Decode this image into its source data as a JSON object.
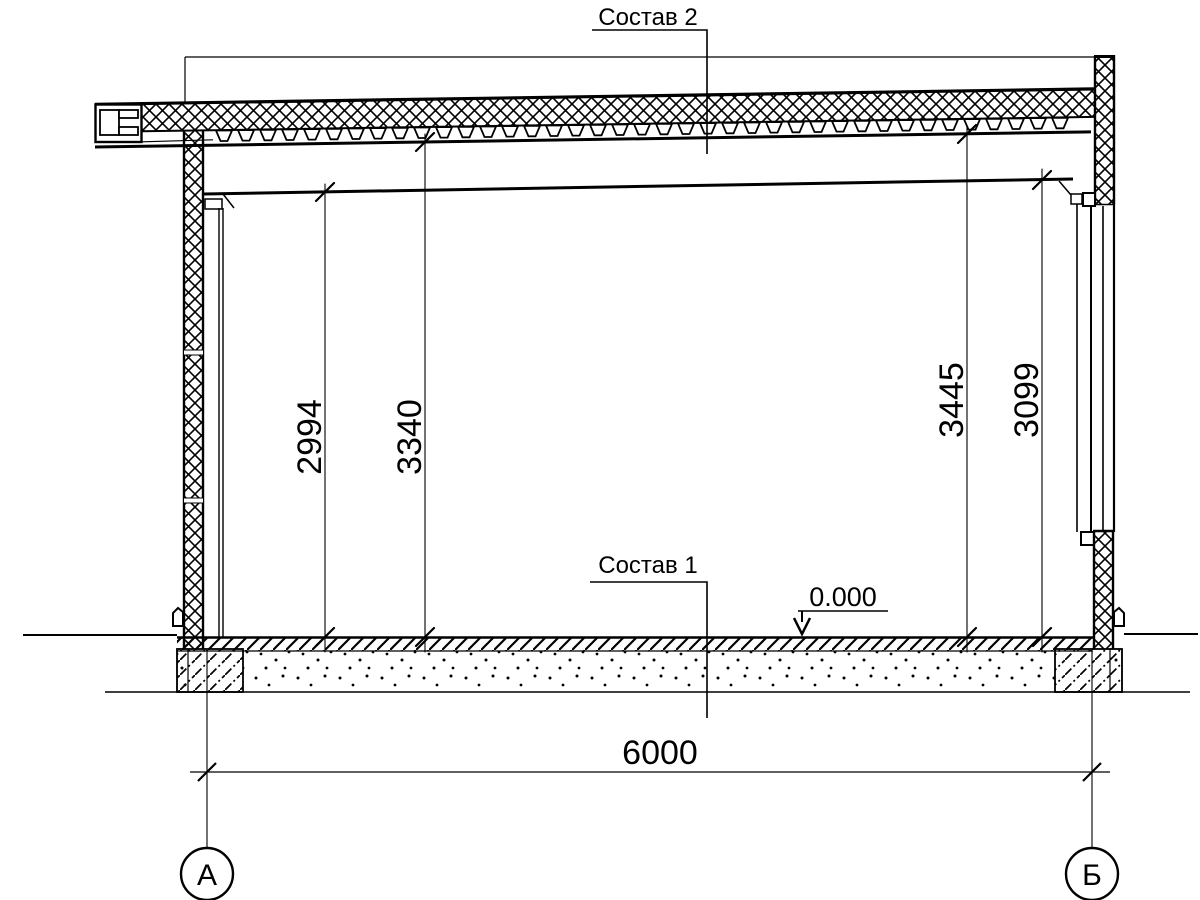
{
  "labels": {
    "roof_composition": "Состав 2",
    "floor_composition": "Состав 1",
    "elevation": "0.000"
  },
  "dimensions": {
    "span": "6000",
    "vertical": [
      {
        "value": "2994"
      },
      {
        "value": "3340"
      },
      {
        "value": "3445"
      },
      {
        "value": "3099"
      }
    ]
  },
  "axes": [
    {
      "label": "А"
    },
    {
      "label": "Б"
    }
  ],
  "colors": {
    "line": "#000000",
    "background": "#ffffff"
  }
}
